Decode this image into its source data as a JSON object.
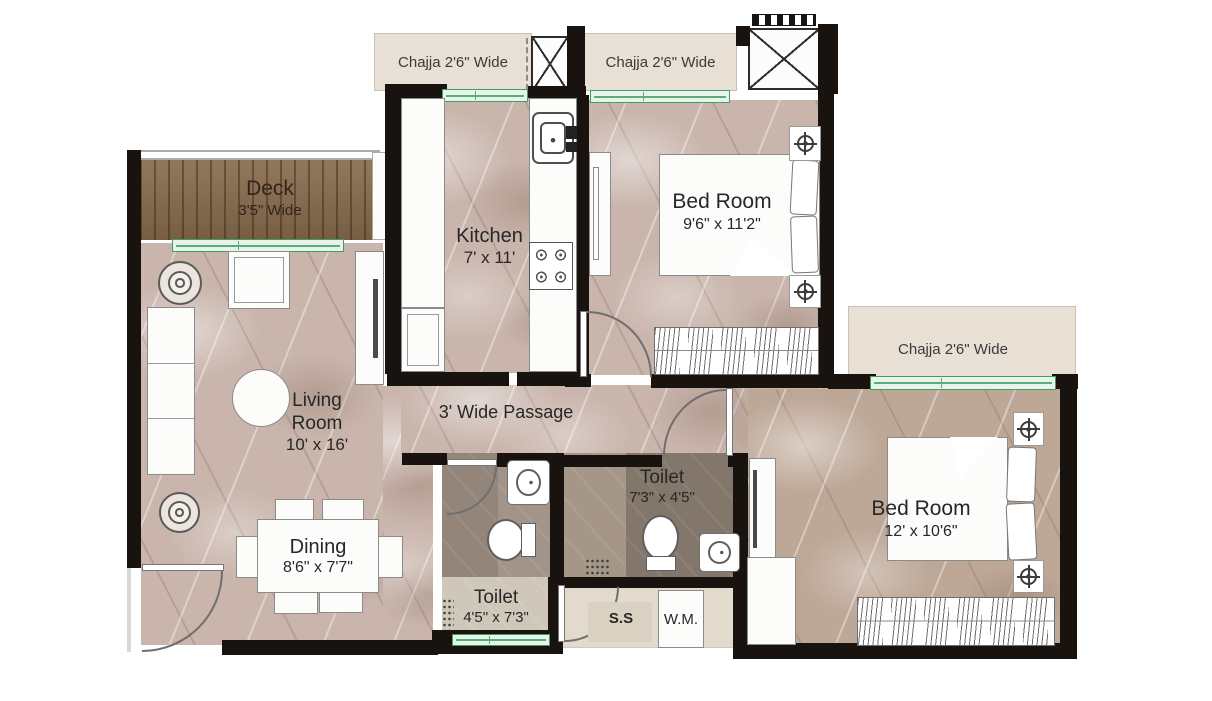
{
  "colors": {
    "wall": "#18130f",
    "marble_floor": "#c9b5ac",
    "wood_deck": "#85684a",
    "chajja_beige": "#e8e0d4",
    "window_green": "#3f9e68",
    "toilet_dark": "#83766a",
    "utility_beige": "#e2dbcd"
  },
  "chajjas": {
    "top_left": {
      "label": "Chajja 2'6\" Wide"
    },
    "top_right": {
      "label": "Chajja 2'6\" Wide"
    },
    "right": {
      "label": "Chajja 2'6\" Wide"
    }
  },
  "rooms": {
    "deck": {
      "name": "Deck",
      "dims": "3'5\" Wide"
    },
    "living": {
      "name": "Living Room",
      "dims": "10' x 16'"
    },
    "dining": {
      "name": "Dining",
      "dims": "8'6\" x 7'7\""
    },
    "kitchen": {
      "name": "Kitchen",
      "dims": "7' x 11'"
    },
    "bedroom_top": {
      "name": "Bed Room",
      "dims": "9'6\" x 11'2\""
    },
    "bedroom_right": {
      "name": "Bed Room",
      "dims": "12' x 10'6\""
    },
    "toilet_long": {
      "name": "Toilet",
      "dims": "4'5\" x 7'3\""
    },
    "toilet_small": {
      "name": "Toilet",
      "dims": "7'3\" x 4'5\""
    },
    "passage": {
      "name": "3' Wide Passage"
    }
  },
  "utility": {
    "sink_label": "S.S",
    "washing_machine_label": "W.M."
  }
}
